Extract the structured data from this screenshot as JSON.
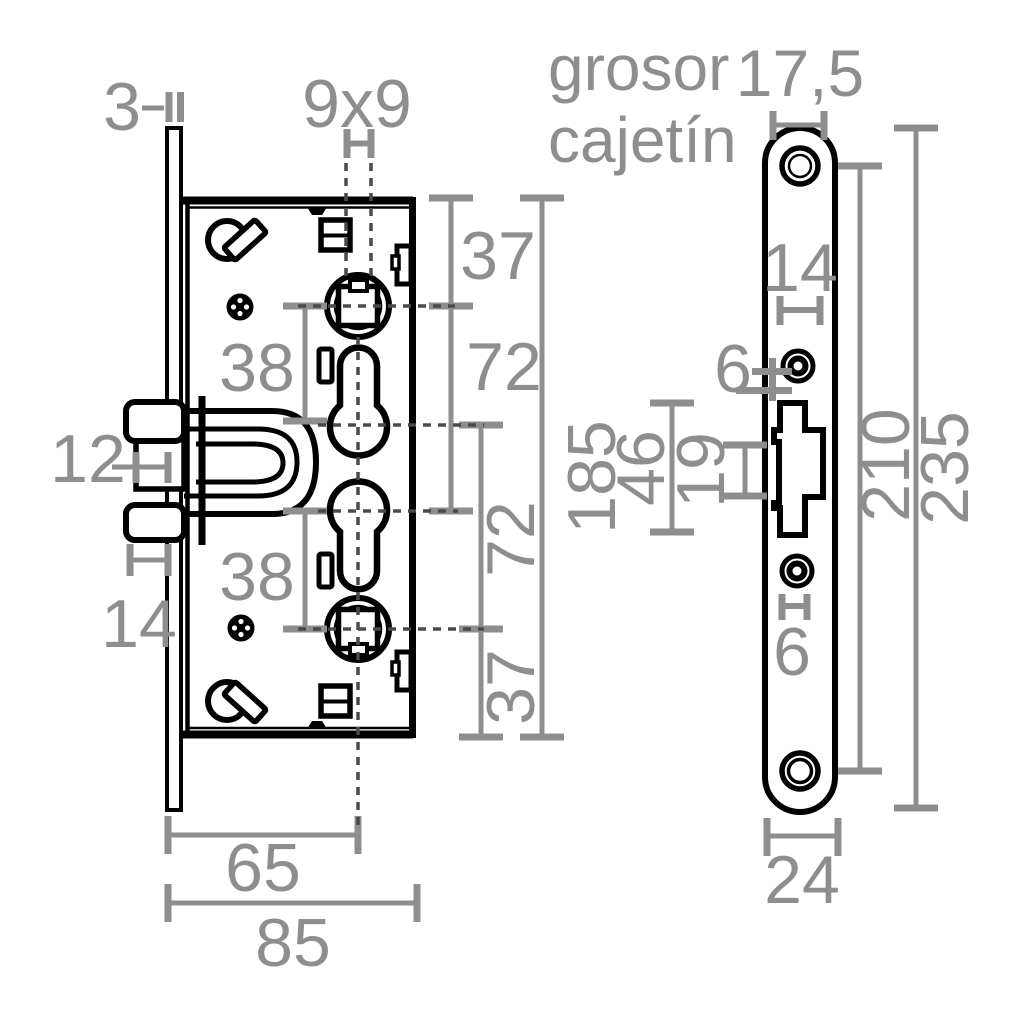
{
  "drawing_title": "mortise lock dimension drawing",
  "colors": {
    "outline": "#000000",
    "dimension": "#8e8e8e",
    "centerline": "#4a4a4a",
    "background": "#ffffff"
  },
  "body_view": {
    "dims": {
      "plate_thickness": "3",
      "spindle_square": "9x9",
      "top_to_spindle": "37",
      "spindle_to_cylinder_cross": "72",
      "case_height": "185",
      "cylinder_to_spindle_cross": "72",
      "spindle_to_bottom": "37",
      "spindle_cylinder_upper": "38",
      "spindle_cylinder_lower": "38",
      "bolt_mouth_projection": "12",
      "bolt_projection": "14",
      "backset": "65",
      "case_depth": "85"
    }
  },
  "plate_view": {
    "note_line1": "grosor",
    "note_line2": "cajetín",
    "dims": {
      "case_thickness": "17,5",
      "window_width": "14",
      "hole_upper_diameter": "6",
      "cutout_height": "46",
      "window_height": "19",
      "screw_center_distance": "210",
      "plate_height": "235",
      "hole_lower_diameter": "6",
      "plate_width": "24"
    }
  }
}
